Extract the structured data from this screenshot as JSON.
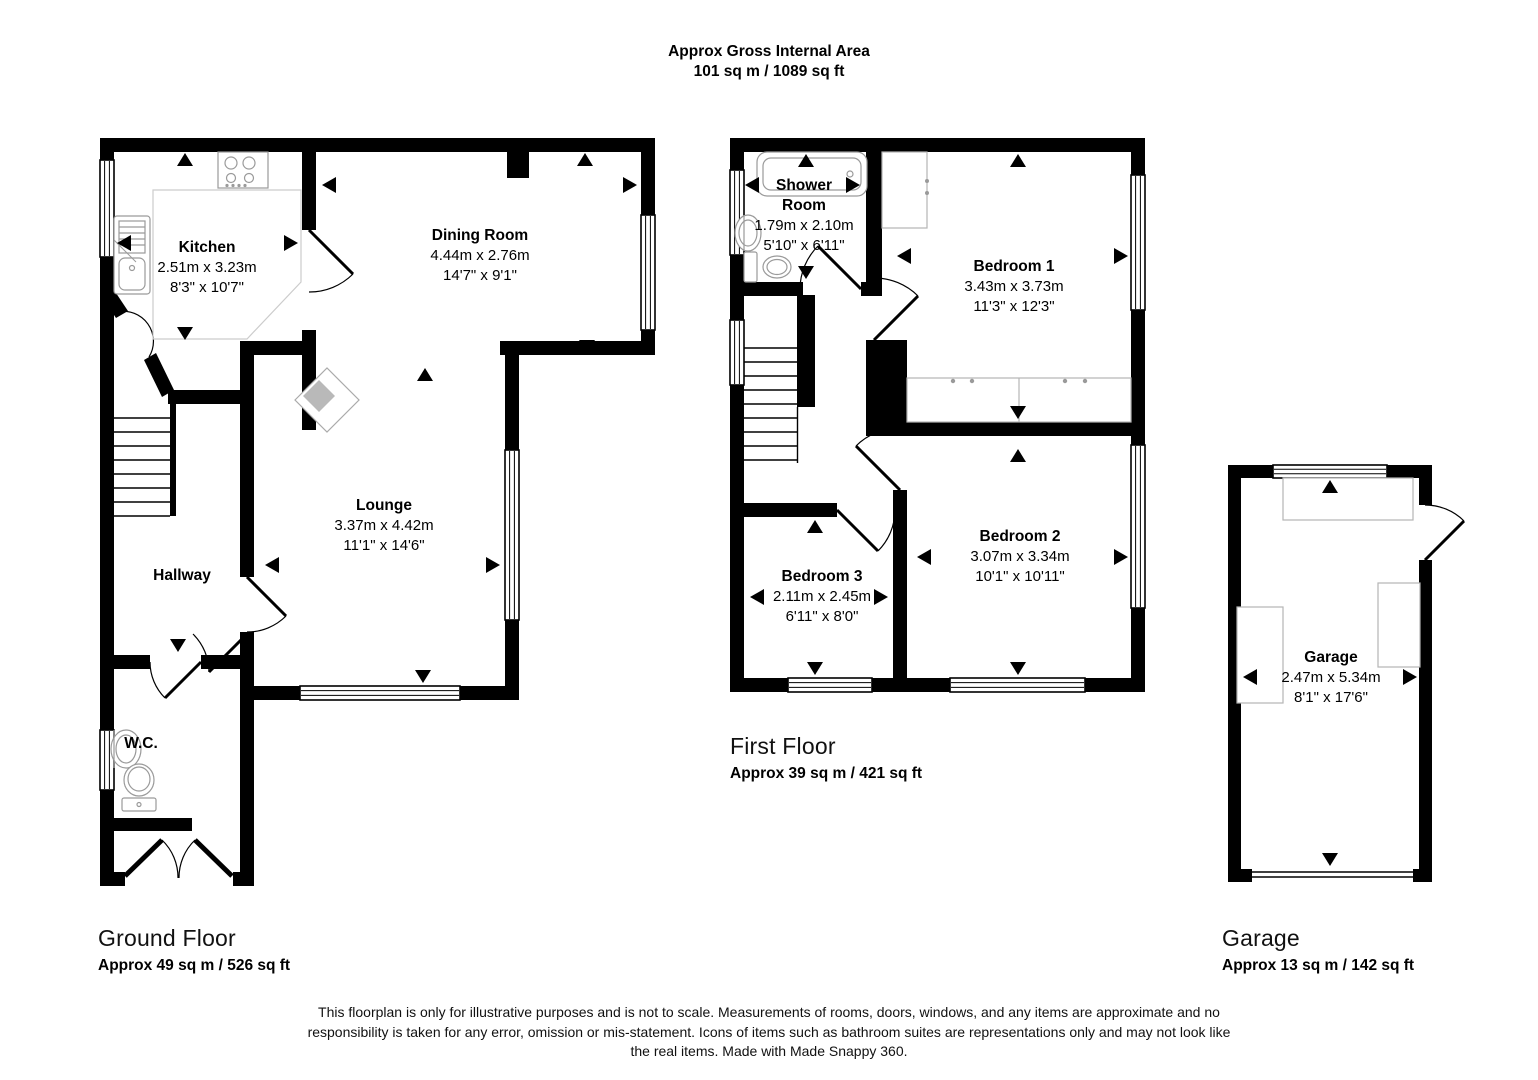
{
  "title": {
    "line1": "Approx Gross Internal Area",
    "line2": "101 sq m / 1089 sq ft"
  },
  "floors": {
    "ground": {
      "caption": "Ground Floor",
      "area": "Approx 49 sq m / 526 sq ft"
    },
    "first": {
      "caption": "First Floor",
      "area": "Approx 39 sq m / 421 sq ft"
    },
    "garage": {
      "caption": "Garage",
      "area": "Approx 13 sq m / 142 sq ft"
    }
  },
  "rooms": {
    "kitchen": {
      "name": "Kitchen",
      "metric": "2.51m x 3.23m",
      "imperial": "8'3\" x 10'7\""
    },
    "dining": {
      "name": "Dining Room",
      "metric": "4.44m x 2.76m",
      "imperial": "14'7\" x 9'1\""
    },
    "lounge": {
      "name": "Lounge",
      "metric": "3.37m x 4.42m",
      "imperial": "11'1\" x 14'6\""
    },
    "hallway": {
      "name": "Hallway"
    },
    "wc": {
      "name": "W.C."
    },
    "shower": {
      "name_line1": "Shower",
      "name_line2": "Room",
      "metric": "1.79m x 2.10m",
      "imperial": "5'10\" x 6'11\""
    },
    "bedroom1": {
      "name": "Bedroom 1",
      "metric": "3.43m x 3.73m",
      "imperial": "11'3\" x 12'3\""
    },
    "bedroom2": {
      "name": "Bedroom 2",
      "metric": "3.07m x 3.34m",
      "imperial": "10'1\" x 10'11\""
    },
    "bedroom3": {
      "name": "Bedroom 3",
      "metric": "2.11m x 2.45m",
      "imperial": "6'11\" x 8'0\""
    },
    "garage": {
      "name": "Garage",
      "metric": "2.47m x 5.34m",
      "imperial": "8'1\" x 17'6\""
    }
  },
  "disclaimer": "This floorplan is only for illustrative purposes and is not to scale. Measurements of rooms, doors, windows, and any items are approximate and no responsibility is taken for any error, omission or mis-statement. Icons of items such as bathroom suites are representations only and may not look like the real items. Made with Made Snappy 360.",
  "colors": {
    "wall": "#000000",
    "fixture": "#9a9a9a",
    "fireplace": "#b9b9b9"
  }
}
